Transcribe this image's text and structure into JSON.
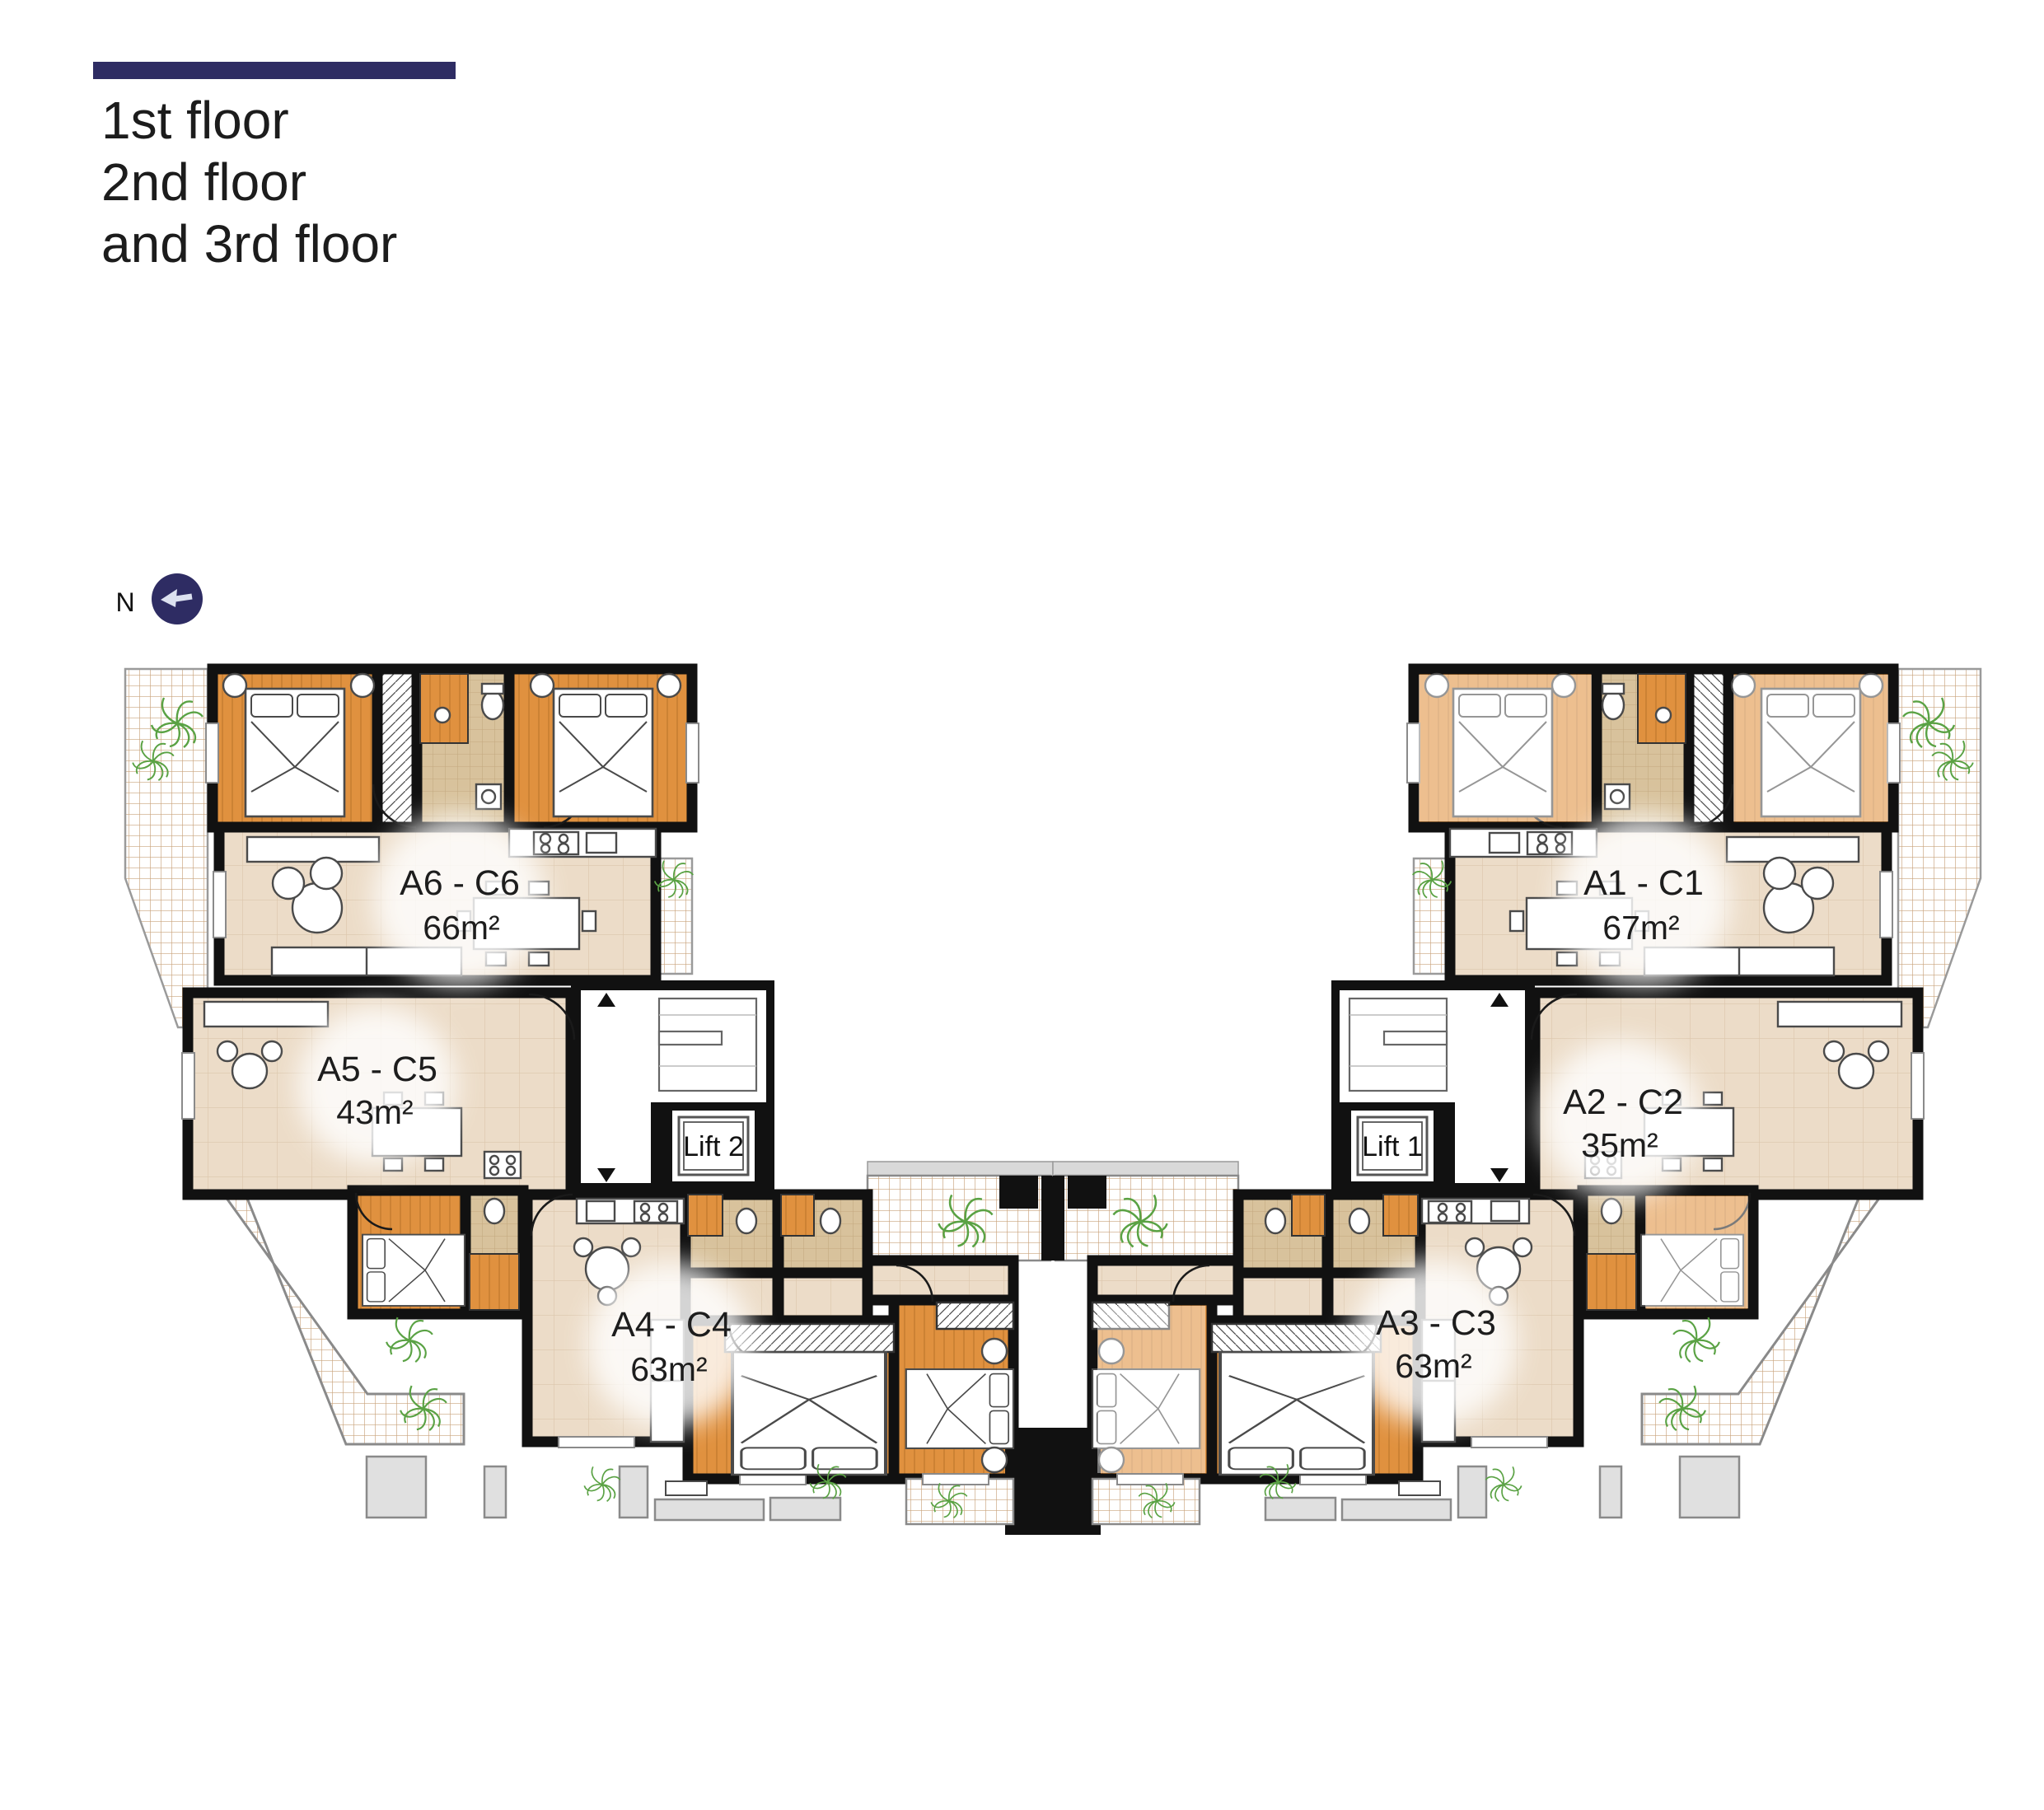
{
  "title": {
    "lines": [
      "1st floor",
      "2nd floor",
      "and 3rd floor"
    ]
  },
  "compass": {
    "label": "N"
  },
  "units": [
    {
      "code": "A6 - C6",
      "area": "66m²"
    },
    {
      "code": "A5 - C5",
      "area": "43m²"
    },
    {
      "code": "A4 - C4",
      "area": "63m²"
    },
    {
      "code": "A1 - C1",
      "area": "67m²"
    },
    {
      "code": "A2 - C2",
      "area": "35m²"
    },
    {
      "code": "A3 - C3",
      "area": "63m²"
    }
  ],
  "lifts": [
    {
      "label": "Lift 2"
    },
    {
      "label": "Lift 1"
    }
  ],
  "colors": {
    "accent_navy": "#2e2c63",
    "bedroom_wood": "#e0913f",
    "light_wood": "#eed6ab",
    "living_floor": "#ecdcc8",
    "bath_tile": "#d8c29c",
    "terrace_grid": "#c9a37c",
    "plant_green": "#5aa244",
    "wall": "#111111",
    "concrete": "#e0e0e0"
  }
}
